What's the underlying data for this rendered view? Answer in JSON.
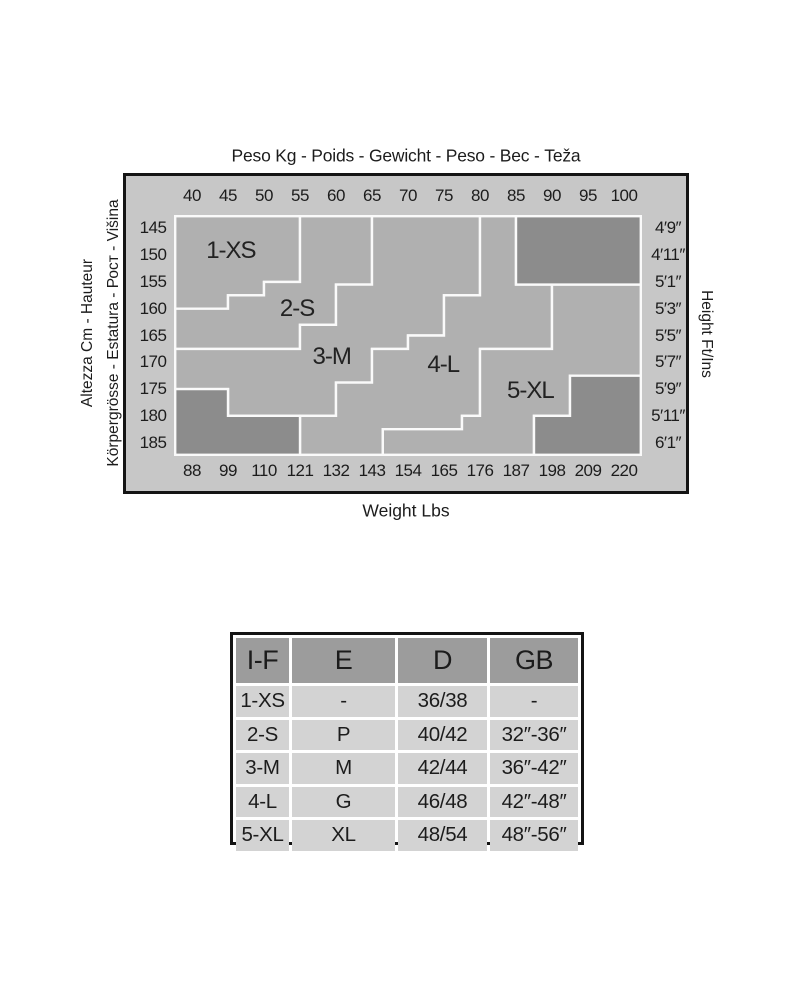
{
  "colors": {
    "frame_bg": "#c7c7c7",
    "zone_fill": "#b0b0b0",
    "dark_fill": "#8c8c8c",
    "line_white": "#fafafa",
    "border_black": "#141414",
    "table_header_bg": "#9c9c9c",
    "table_cell_bg": "#d3d3d3",
    "text": "#1c1c1c"
  },
  "chart_data": {
    "type": "heatmap",
    "title": "Peso Kg - Poids - Gewicht - Peso - Вес - Teža",
    "bottom_axis_title": "Weight Lbs",
    "left_axis_title_line1": "Altezza Cm - Hauteur",
    "left_axis_title_line2": "Körpergrösse - Estatura - Рост - Višina",
    "right_axis_title": "Height Ft/Ins",
    "x_top_ticks_kg": [
      40,
      45,
      50,
      55,
      60,
      65,
      70,
      75,
      80,
      85,
      90,
      95,
      100
    ],
    "x_bottom_ticks_lbs": [
      88,
      99,
      110,
      121,
      132,
      143,
      154,
      165,
      176,
      187,
      198,
      209,
      220
    ],
    "y_left_ticks_cm": [
      145,
      150,
      155,
      160,
      165,
      170,
      175,
      180,
      185
    ],
    "y_right_ticks_ftins": [
      "4′9″",
      "4′11″",
      "5′1″",
      "5′3″",
      "5′5″",
      "5′7″",
      "5′9″",
      "5′11″",
      "6′1″"
    ],
    "x_range_kg": [
      37.5,
      102.5
    ],
    "y_range_cm": [
      142.5,
      187.5
    ],
    "zones": [
      {
        "name": "1-XS",
        "label_at": [
          45.4,
          149.3
        ],
        "polygon": [
          [
            37.5,
            142.5
          ],
          [
            55,
            142.5
          ],
          [
            55,
            155
          ],
          [
            50,
            155
          ],
          [
            50,
            157.5
          ],
          [
            45,
            157.5
          ],
          [
            45,
            160
          ],
          [
            37.5,
            160
          ]
        ]
      },
      {
        "name": "2-S",
        "label_at": [
          54.6,
          160.0
        ],
        "polygon": [
          [
            55,
            142.5
          ],
          [
            65,
            142.5
          ],
          [
            65,
            155.5
          ],
          [
            60,
            155.5
          ],
          [
            60,
            163
          ],
          [
            55,
            163
          ],
          [
            55,
            167.5
          ],
          [
            37.5,
            167.5
          ],
          [
            37.5,
            160
          ],
          [
            45,
            160
          ],
          [
            45,
            157.5
          ],
          [
            50,
            157.5
          ],
          [
            50,
            155
          ],
          [
            55,
            155
          ]
        ]
      },
      {
        "name": "3-M",
        "label_at": [
          59.4,
          169.0
        ],
        "polygon": [
          [
            65,
            142.5
          ],
          [
            80,
            142.5
          ],
          [
            80,
            157.5
          ],
          [
            75,
            157.5
          ],
          [
            75,
            165
          ],
          [
            70,
            165
          ],
          [
            70,
            167.5
          ],
          [
            65,
            167.5
          ],
          [
            65,
            173.8
          ],
          [
            60,
            173.8
          ],
          [
            60,
            180
          ],
          [
            45,
            180
          ],
          [
            45,
            175
          ],
          [
            37.5,
            175
          ],
          [
            37.5,
            167.5
          ],
          [
            55,
            167.5
          ],
          [
            55,
            163
          ],
          [
            60,
            163
          ],
          [
            60,
            155.5
          ],
          [
            65,
            155.5
          ]
        ]
      },
      {
        "name": "4-L",
        "label_at": [
          74.9,
          170.6
        ],
        "polygon": [
          [
            80,
            142.5
          ],
          [
            85,
            142.5
          ],
          [
            85,
            155.5
          ],
          [
            90,
            155.5
          ],
          [
            90,
            167.5
          ],
          [
            80,
            167.5
          ],
          [
            80,
            180
          ],
          [
            77.5,
            180
          ],
          [
            77.5,
            182.5
          ],
          [
            66.5,
            182.5
          ],
          [
            66.5,
            187.5
          ],
          [
            55,
            187.5
          ],
          [
            55,
            180
          ],
          [
            60,
            180
          ],
          [
            60,
            173.8
          ],
          [
            65,
            173.8
          ],
          [
            65,
            167.5
          ],
          [
            70,
            167.5
          ],
          [
            70,
            165
          ],
          [
            75,
            165
          ],
          [
            75,
            157.5
          ],
          [
            80,
            157.5
          ]
        ]
      },
      {
        "name": "5-XL",
        "label_at": [
          87.0,
          175.3
        ],
        "polygon": [
          [
            90,
            155.5
          ],
          [
            102.5,
            155.5
          ],
          [
            102.5,
            172.5
          ],
          [
            92.5,
            172.5
          ],
          [
            92.5,
            180
          ],
          [
            87.5,
            180
          ],
          [
            87.5,
            187.5
          ],
          [
            66.5,
            187.5
          ],
          [
            66.5,
            182.5
          ],
          [
            77.5,
            182.5
          ],
          [
            77.5,
            180
          ],
          [
            80,
            180
          ],
          [
            80,
            167.5
          ],
          [
            90,
            167.5
          ]
        ]
      }
    ],
    "out_of_range_blocks": [
      [
        [
          85,
          142.5
        ],
        [
          102.5,
          142.5
        ],
        [
          102.5,
          155.5
        ],
        [
          85,
          155.5
        ]
      ],
      [
        [
          37.5,
          175
        ],
        [
          45,
          175
        ],
        [
          45,
          180
        ],
        [
          55,
          180
        ],
        [
          55,
          187.5
        ],
        [
          37.5,
          187.5
        ]
      ],
      [
        [
          92.5,
          172.5
        ],
        [
          102.5,
          172.5
        ],
        [
          102.5,
          187.5
        ],
        [
          87.5,
          187.5
        ],
        [
          87.5,
          180
        ],
        [
          92.5,
          180
        ]
      ]
    ]
  },
  "table": {
    "headers": [
      "I-F",
      "E",
      "D",
      "GB"
    ],
    "rows": [
      [
        "1-XS",
        "-",
        "36/38",
        "-"
      ],
      [
        "2-S",
        "P",
        "40/42",
        "32″-36″"
      ],
      [
        "3-M",
        "M",
        "42/44",
        "36″-42″"
      ],
      [
        "4-L",
        "G",
        "46/48",
        "42″-48″"
      ],
      [
        "5-XL",
        "XL",
        "48/54",
        "48″-56″"
      ]
    ]
  }
}
